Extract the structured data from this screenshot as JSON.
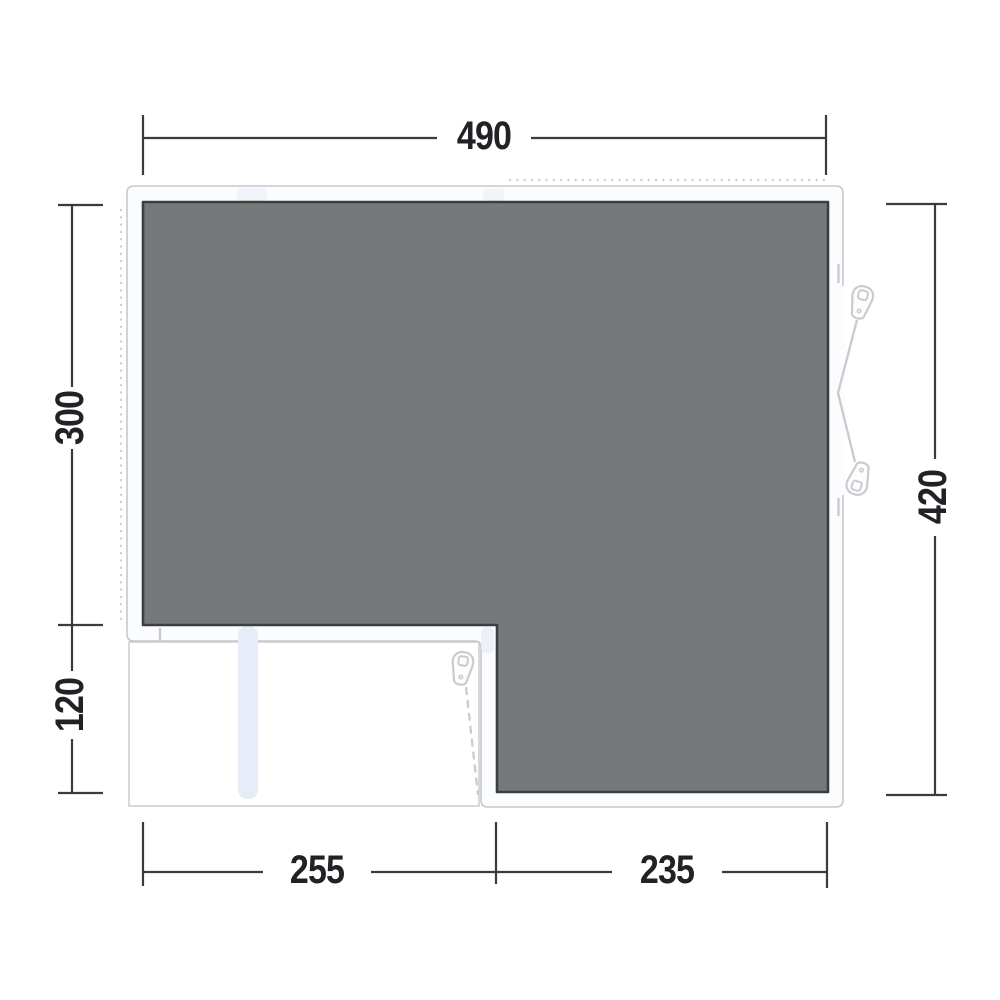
{
  "diagram": {
    "dimensions": {
      "width_top": "490",
      "height_left_upper": "300",
      "height_left_lower": "120",
      "height_right": "420",
      "width_bottom_left": "255",
      "width_bottom_right": "235"
    },
    "icons": {
      "zipper_pull_right_top": "zipper-pull-icon",
      "zipper_pull_right_bottom": "zipper-pull-icon",
      "zipper_pull_front": "zipper-pull-icon"
    },
    "colors": {
      "floor": "#77787a",
      "floor_outline": "#3d3e40",
      "wall_fill": "#fbfcfd",
      "wall_stroke": "#c6c8cc",
      "accent_blue": "#e7edf8",
      "dim_line": "#3a3b3d",
      "dim_text": "#212225",
      "dotted": "#cfd0d4",
      "zipper": "#c9cbcf"
    }
  }
}
